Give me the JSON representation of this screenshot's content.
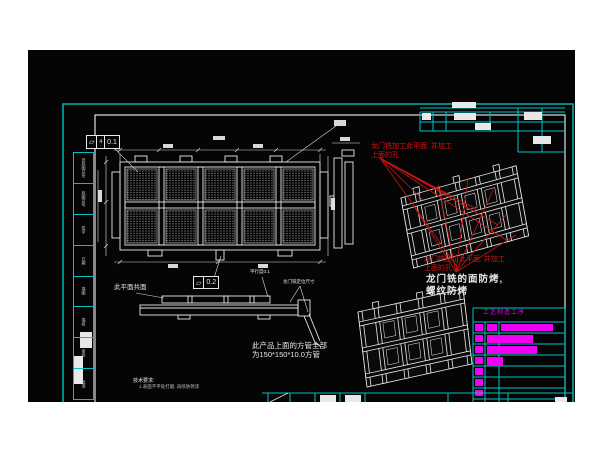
{
  "drawing": {
    "fcf_top": {
      "symbol": "⏥",
      "datum": "4",
      "value": "0.1"
    },
    "fcf_bottom": {
      "symbol": "⏥",
      "value": "0.2"
    },
    "labels": {
      "coplanar": "此平面共面",
      "parallelism": "平行度0.1",
      "gantry_dim": "龙门铣定位尺寸"
    },
    "notes": {
      "red_line1": "龙门铣加工此平面, 并加工",
      "red_line2": "上面的孔",
      "face_line1": "龙门铣的面防烤,",
      "face_line2": "螺纹防烤",
      "tube_line1": "此产品上面的方管全部",
      "tube_line2": "为150*150*10.0方管",
      "tech_title": "技术要求:",
      "tech_item": "1.表面不平处打磨, 再喷防锈漆"
    },
    "title_block": {
      "header": "工艺制造工序"
    },
    "sidebar_cells": [
      "旧底图总号",
      "底图总号",
      "签字",
      "日期",
      "描图",
      "描校",
      "审核",
      "批准"
    ]
  },
  "colors": {
    "cyan": "#00c2c2",
    "white_line": "#e8e8e8",
    "red": "#d81414",
    "magenta": "#f000f0",
    "canvas_bg": "#050505"
  }
}
